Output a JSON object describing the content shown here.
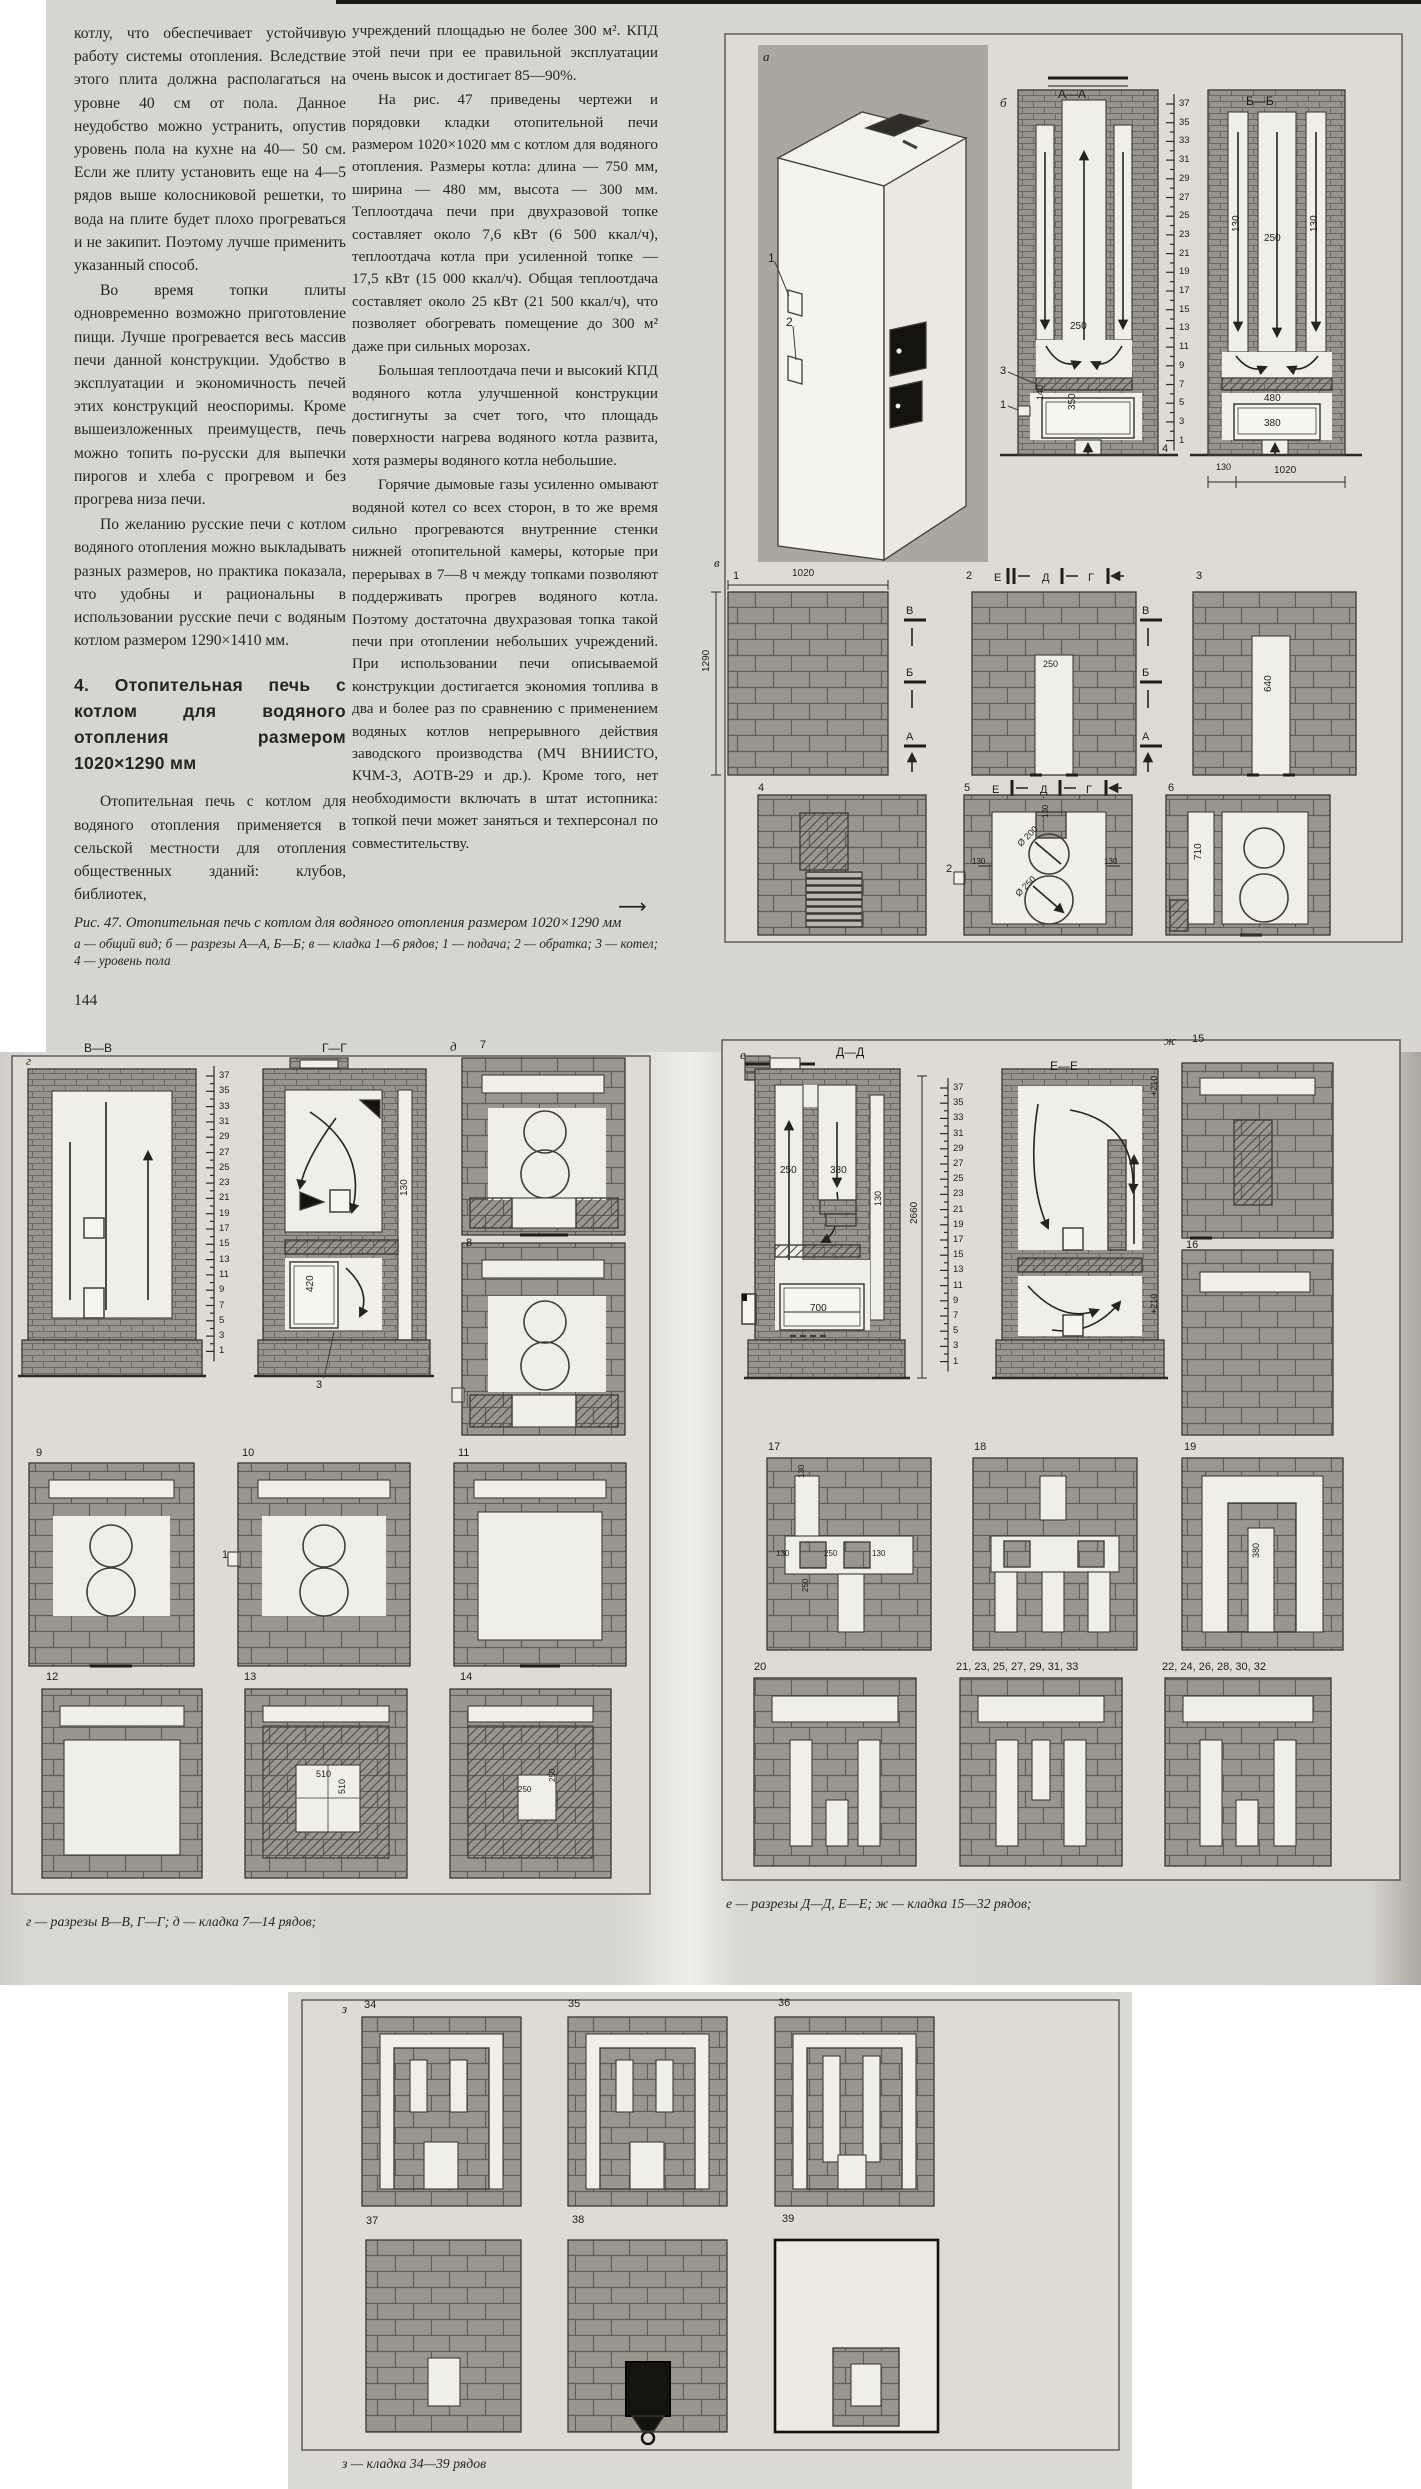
{
  "text": {
    "left_column": [
      "котлу, что обеспечивает устойчивую работу системы отопления. Вследствие этого плита должна располагаться на уровне 40 см от пола. Данное неудобство можно устранить, опустив уровень пола на кухне на 40— 50 см. Если же плиту установить еще на 4—5 рядов выше колосниковой решетки, то вода на плите будет плохо прогреваться и не закипит. Поэтому лучше применить указанный способ.",
      "Во время топки плиты одновременно возможно приготовление пищи. Лучше прогревается весь массив печи данной конструкции. Удобство в эксплуатации и экономичность печей этих конструкций неоспоримы. Кроме вышеизложенных преимуществ, печь можно топить по-русски для выпечки пирогов и хлеба с прогревом и без прогрева низа печи.",
      "По желанию русские печи с котлом водяного отопления можно выкладывать разных размеров, но практика показала, что удобны и рациональны в использовании русские печи с водяным котлом размером 1290×1410 мм."
    ],
    "heading": "4. Отопительная печь с котлом для водяного отопления размером 1020×1290 мм",
    "left_tail": "Отопительная печь с котлом для водяного отопления применяется в сельской местности для отопления общественных зданий: клубов, библиотек,",
    "right_column": [
      "учреждений площадью не более 300 м². КПД этой печи при ее правильной эксплуатации очень высок и достигает 85—90%.",
      "На рис. 47 приведены чертежи и порядовки кладки отопительной печи размером 1020×1020 мм с котлом для водяного отопления. Размеры котла: длина — 750 мм, ширина — 480 мм, высота — 300 мм. Теплоотдача печи при двухразовой топке составляет около 7,6 кВт (6 500 ккал/ч), теплоотдача котла при усиленной топке — 17,5 кВт (15 000 ккал/ч). Общая теплоотдача составляет около 25 кВт (21 500 ккал/ч), что позволяет обогревать помещение до 300 м² даже при сильных морозах.",
      "Большая теплоотдача печи и высокий КПД водяного котла улучшенной конструкции достигнуты за счет того, что площадь поверхности нагрева водяного котла развита, хотя размеры водяного котла небольшие.",
      "Горячие дымовые газы усиленно омывают водяной котел со всех сторон, в то же время сильно прогреваются внутренние стенки нижней отопительной камеры, которые при перерывах в 7—8 ч между топками позволяют поддерживать прогрев водяного котла. Поэтому достаточна двухразовая топка такой печи при отоплении небольших учреждений. При использовании печи описываемой конструкции достигается экономия топлива в два и более раз по сравнению с применением водяных котлов непрерывного действия заводского производства (МЧ ВНИИСТО, КЧМ-3, АОТВ-29 и др.). Кроме того, нет необходимости включать в штат истопника: топкой печи может заняться и техперсонал по совместительству."
    ],
    "continuation_arrow": "⟶",
    "caption_title": "Рис. 47. Отопительная печь с котлом для водяного отопления размером 1020×1290 мм",
    "caption_legend": "а — общий вид; б — разрезы А—А, Б—Б; в — кладка 1—6 рядов; 1 — подача; 2 — обратка; 3 — котел; 4 — уровень пола",
    "page_number": "144"
  },
  "captions": {
    "g": "г — разрезы В—В, Г—Г; д — кладка 7—14 рядов;",
    "e": "е — разрезы Д—Д, Е—Е; ж — кладка 15—32 рядов;",
    "z": "з — кладка 34—39 рядов"
  },
  "scales": {
    "a": {
      "x": 1174,
      "label_x": 1179,
      "y0": 104,
      "dy": 18.7,
      "tick": 8,
      "nums": [
        "37",
        "35",
        "33",
        "31",
        "29",
        "27",
        "25",
        "23",
        "21",
        "19",
        "17",
        "15",
        "13",
        "11",
        "9",
        "7",
        "5",
        "3",
        "1"
      ]
    },
    "b": {
      "x": 214,
      "label_x": 219,
      "y0": 1076,
      "dy": 15.3,
      "tick": 8,
      "nums": [
        "37",
        "35",
        "33",
        "31",
        "29",
        "27",
        "25",
        "23",
        "21",
        "19",
        "17",
        "15",
        "13",
        "11",
        "9",
        "7",
        "5",
        "3",
        "1"
      ]
    },
    "d": {
      "x": 948,
      "label_x": 953,
      "y0": 1088,
      "dy": 15.2,
      "tick": 8,
      "nums": [
        "37",
        "35",
        "33",
        "31",
        "29",
        "27",
        "25",
        "23",
        "21",
        "19",
        "17",
        "15",
        "13",
        "11",
        "9",
        "7",
        "5",
        "3",
        "1"
      ]
    }
  },
  "labels": [
    {
      "t": "а",
      "x": 763,
      "y": 50,
      "fs": 13,
      "i": 1
    },
    {
      "t": "1",
      "x": 768,
      "y": 252,
      "fs": 12
    },
    {
      "t": "2",
      "x": 786,
      "y": 316,
      "fs": 12
    },
    {
      "t": "б",
      "x": 1000,
      "y": 96,
      "fs": 13,
      "i": 1
    },
    {
      "t": "А—А",
      "x": 1058,
      "y": 88,
      "fs": 12
    },
    {
      "t": "Б—Б",
      "x": 1246,
      "y": 95,
      "fs": 12
    },
    {
      "t": "250",
      "x": 1070,
      "y": 322,
      "fs": 10
    },
    {
      "t": "140",
      "x": 1036,
      "y": 400,
      "fs": 9,
      "r": -90
    },
    {
      "t": "350",
      "x": 1068,
      "y": 410,
      "fs": 10,
      "r": -90
    },
    {
      "t": "3",
      "x": 1000,
      "y": 366,
      "fs": 11
    },
    {
      "t": "1",
      "x": 1000,
      "y": 400,
      "fs": 11
    },
    {
      "t": "4",
      "x": 1162,
      "y": 444,
      "fs": 11
    },
    {
      "t": "130",
      "x": 1232,
      "y": 232,
      "fs": 10,
      "r": -90
    },
    {
      "t": "250",
      "x": 1264,
      "y": 234,
      "fs": 10
    },
    {
      "t": "130",
      "x": 1310,
      "y": 232,
      "fs": 10,
      "r": -90
    },
    {
      "t": "480",
      "x": 1264,
      "y": 394,
      "fs": 10
    },
    {
      "t": "380",
      "x": 1264,
      "y": 419,
      "fs": 10
    },
    {
      "t": "130",
      "x": 1216,
      "y": 463,
      "fs": 9
    },
    {
      "t": "1020",
      "x": 1274,
      "y": 466,
      "fs": 10
    },
    {
      "t": "в",
      "x": 714,
      "y": 556,
      "fs": 13,
      "i": 1
    },
    {
      "t": "1",
      "x": 733,
      "y": 571,
      "fs": 11
    },
    {
      "t": "1020",
      "x": 792,
      "y": 569,
      "fs": 10
    },
    {
      "t": "1290",
      "x": 702,
      "y": 672,
      "fs": 10,
      "r": -90
    },
    {
      "t": "В",
      "x": 906,
      "y": 606,
      "fs": 11
    },
    {
      "t": "Б",
      "x": 906,
      "y": 668,
      "fs": 11
    },
    {
      "t": "А",
      "x": 906,
      "y": 732,
      "fs": 11
    },
    {
      "t": "2",
      "x": 966,
      "y": 571,
      "fs": 11
    },
    {
      "t": "Е",
      "x": 994,
      "y": 573,
      "fs": 11
    },
    {
      "t": "Д",
      "x": 1042,
      "y": 573,
      "fs": 11
    },
    {
      "t": "Г",
      "x": 1088,
      "y": 573,
      "fs": 11
    },
    {
      "t": "250",
      "x": 1043,
      "y": 660,
      "fs": 9
    },
    {
      "t": "В",
      "x": 1142,
      "y": 606,
      "fs": 11
    },
    {
      "t": "Б",
      "x": 1142,
      "y": 668,
      "fs": 11
    },
    {
      "t": "А",
      "x": 1142,
      "y": 732,
      "fs": 11
    },
    {
      "t": "3",
      "x": 1196,
      "y": 571,
      "fs": 11
    },
    {
      "t": "640",
      "x": 1264,
      "y": 692,
      "fs": 10,
      "r": -90
    },
    {
      "t": "4",
      "x": 758,
      "y": 783,
      "fs": 11
    },
    {
      "t": "5",
      "x": 964,
      "y": 783,
      "fs": 11
    },
    {
      "t": "Е",
      "x": 992,
      "y": 785,
      "fs": 11
    },
    {
      "t": "Д",
      "x": 1040,
      "y": 785,
      "fs": 11
    },
    {
      "t": "Г",
      "x": 1086,
      "y": 785,
      "fs": 11
    },
    {
      "t": "6",
      "x": 1168,
      "y": 783,
      "fs": 11
    },
    {
      "t": "130",
      "x": 1042,
      "y": 818,
      "fs": 8,
      "r": -90
    },
    {
      "t": "130",
      "x": 972,
      "y": 858,
      "fs": 8
    },
    {
      "t": "130",
      "x": 1104,
      "y": 858,
      "fs": 8
    },
    {
      "t": "Ø 200",
      "x": 1016,
      "y": 842,
      "fs": 9,
      "r": -45
    },
    {
      "t": "Ø 250",
      "x": 1014,
      "y": 892,
      "fs": 9,
      "r": -45
    },
    {
      "t": "2",
      "x": 946,
      "y": 864,
      "fs": 11
    },
    {
      "t": "710",
      "x": 1194,
      "y": 860,
      "fs": 10,
      "r": -90
    },
    {
      "t": "г",
      "x": 26,
      "y": 1054,
      "fs": 13,
      "i": 1
    },
    {
      "t": "В—В",
      "x": 84,
      "y": 1042,
      "fs": 12
    },
    {
      "t": "Г—Г",
      "x": 322,
      "y": 1042,
      "fs": 12
    },
    {
      "t": "д",
      "x": 450,
      "y": 1040,
      "fs": 13,
      "i": 1
    },
    {
      "t": "7",
      "x": 480,
      "y": 1040,
      "fs": 11
    },
    {
      "t": "130",
      "x": 400,
      "y": 1196,
      "fs": 10,
      "r": -90
    },
    {
      "t": "420",
      "x": 306,
      "y": 1292,
      "fs": 10,
      "r": -90
    },
    {
      "t": "3",
      "x": 316,
      "y": 1380,
      "fs": 11
    },
    {
      "t": "8",
      "x": 466,
      "y": 1238,
      "fs": 11
    },
    {
      "t": "9",
      "x": 36,
      "y": 1448,
      "fs": 11
    },
    {
      "t": "10",
      "x": 242,
      "y": 1448,
      "fs": 11
    },
    {
      "t": "11",
      "x": 458,
      "y": 1448,
      "fs": 11
    },
    {
      "t": "1",
      "x": 222,
      "y": 1550,
      "fs": 11
    },
    {
      "t": "12",
      "x": 46,
      "y": 1672,
      "fs": 11
    },
    {
      "t": "13",
      "x": 244,
      "y": 1672,
      "fs": 11
    },
    {
      "t": "14",
      "x": 460,
      "y": 1672,
      "fs": 11
    },
    {
      "t": "510",
      "x": 316,
      "y": 1770,
      "fs": 9
    },
    {
      "t": "510",
      "x": 338,
      "y": 1794,
      "fs": 9,
      "r": -90
    },
    {
      "t": "250",
      "x": 518,
      "y": 1786,
      "fs": 8
    },
    {
      "t": "250",
      "x": 549,
      "y": 1782,
      "fs": 8,
      "r": -90
    },
    {
      "t": "е",
      "x": 740,
      "y": 1048,
      "fs": 13,
      "i": 1
    },
    {
      "t": "Д—Д",
      "x": 836,
      "y": 1046,
      "fs": 12
    },
    {
      "t": "Е—Е",
      "x": 1050,
      "y": 1060,
      "fs": 12
    },
    {
      "t": "ж",
      "x": 1164,
      "y": 1034,
      "fs": 13,
      "i": 1
    },
    {
      "t": "15",
      "x": 1192,
      "y": 1034,
      "fs": 11
    },
    {
      "t": "250",
      "x": 780,
      "y": 1166,
      "fs": 10
    },
    {
      "t": "380",
      "x": 830,
      "y": 1166,
      "fs": 10
    },
    {
      "t": "130",
      "x": 874,
      "y": 1206,
      "fs": 9,
      "r": -90
    },
    {
      "t": "2660",
      "x": 910,
      "y": 1224,
      "fs": 10,
      "r": -90
    },
    {
      "t": "700",
      "x": 810,
      "y": 1304,
      "fs": 10
    },
    {
      "t": "+210",
      "x": 1150,
      "y": 1096,
      "fs": 9,
      "r": -90
    },
    {
      "t": "+210",
      "x": 1150,
      "y": 1314,
      "fs": 9,
      "r": -90
    },
    {
      "t": "16",
      "x": 1186,
      "y": 1240,
      "fs": 11
    },
    {
      "t": "17",
      "x": 768,
      "y": 1442,
      "fs": 11
    },
    {
      "t": "18",
      "x": 974,
      "y": 1442,
      "fs": 11
    },
    {
      "t": "19",
      "x": 1184,
      "y": 1442,
      "fs": 11
    },
    {
      "t": "130",
      "x": 798,
      "y": 1478,
      "fs": 8,
      "r": -90
    },
    {
      "t": "130",
      "x": 776,
      "y": 1550,
      "fs": 8
    },
    {
      "t": "250",
      "x": 824,
      "y": 1550,
      "fs": 8
    },
    {
      "t": "130",
      "x": 872,
      "y": 1550,
      "fs": 8
    },
    {
      "t": "250",
      "x": 802,
      "y": 1592,
      "fs": 8,
      "r": -90
    },
    {
      "t": "380",
      "x": 1252,
      "y": 1558,
      "fs": 9,
      "r": -90
    },
    {
      "t": "20",
      "x": 754,
      "y": 1662,
      "fs": 11
    },
    {
      "t": "21, 23, 25, 27, 29, 31, 33",
      "x": 956,
      "y": 1662,
      "fs": 11
    },
    {
      "t": "22, 24, 26, 28, 30, 32",
      "x": 1162,
      "y": 1662,
      "fs": 11
    },
    {
      "t": "з",
      "x": 342,
      "y": 2002,
      "fs": 13,
      "i": 1
    },
    {
      "t": "34",
      "x": 364,
      "y": 2000,
      "fs": 11
    },
    {
      "t": "35",
      "x": 568,
      "y": 1999,
      "fs": 11
    },
    {
      "t": "36",
      "x": 778,
      "y": 1998,
      "fs": 11
    },
    {
      "t": "37",
      "x": 366,
      "y": 2216,
      "fs": 11
    },
    {
      "t": "38",
      "x": 572,
      "y": 2215,
      "fs": 11
    },
    {
      "t": "39",
      "x": 782,
      "y": 2214,
      "fs": 11
    }
  ]
}
